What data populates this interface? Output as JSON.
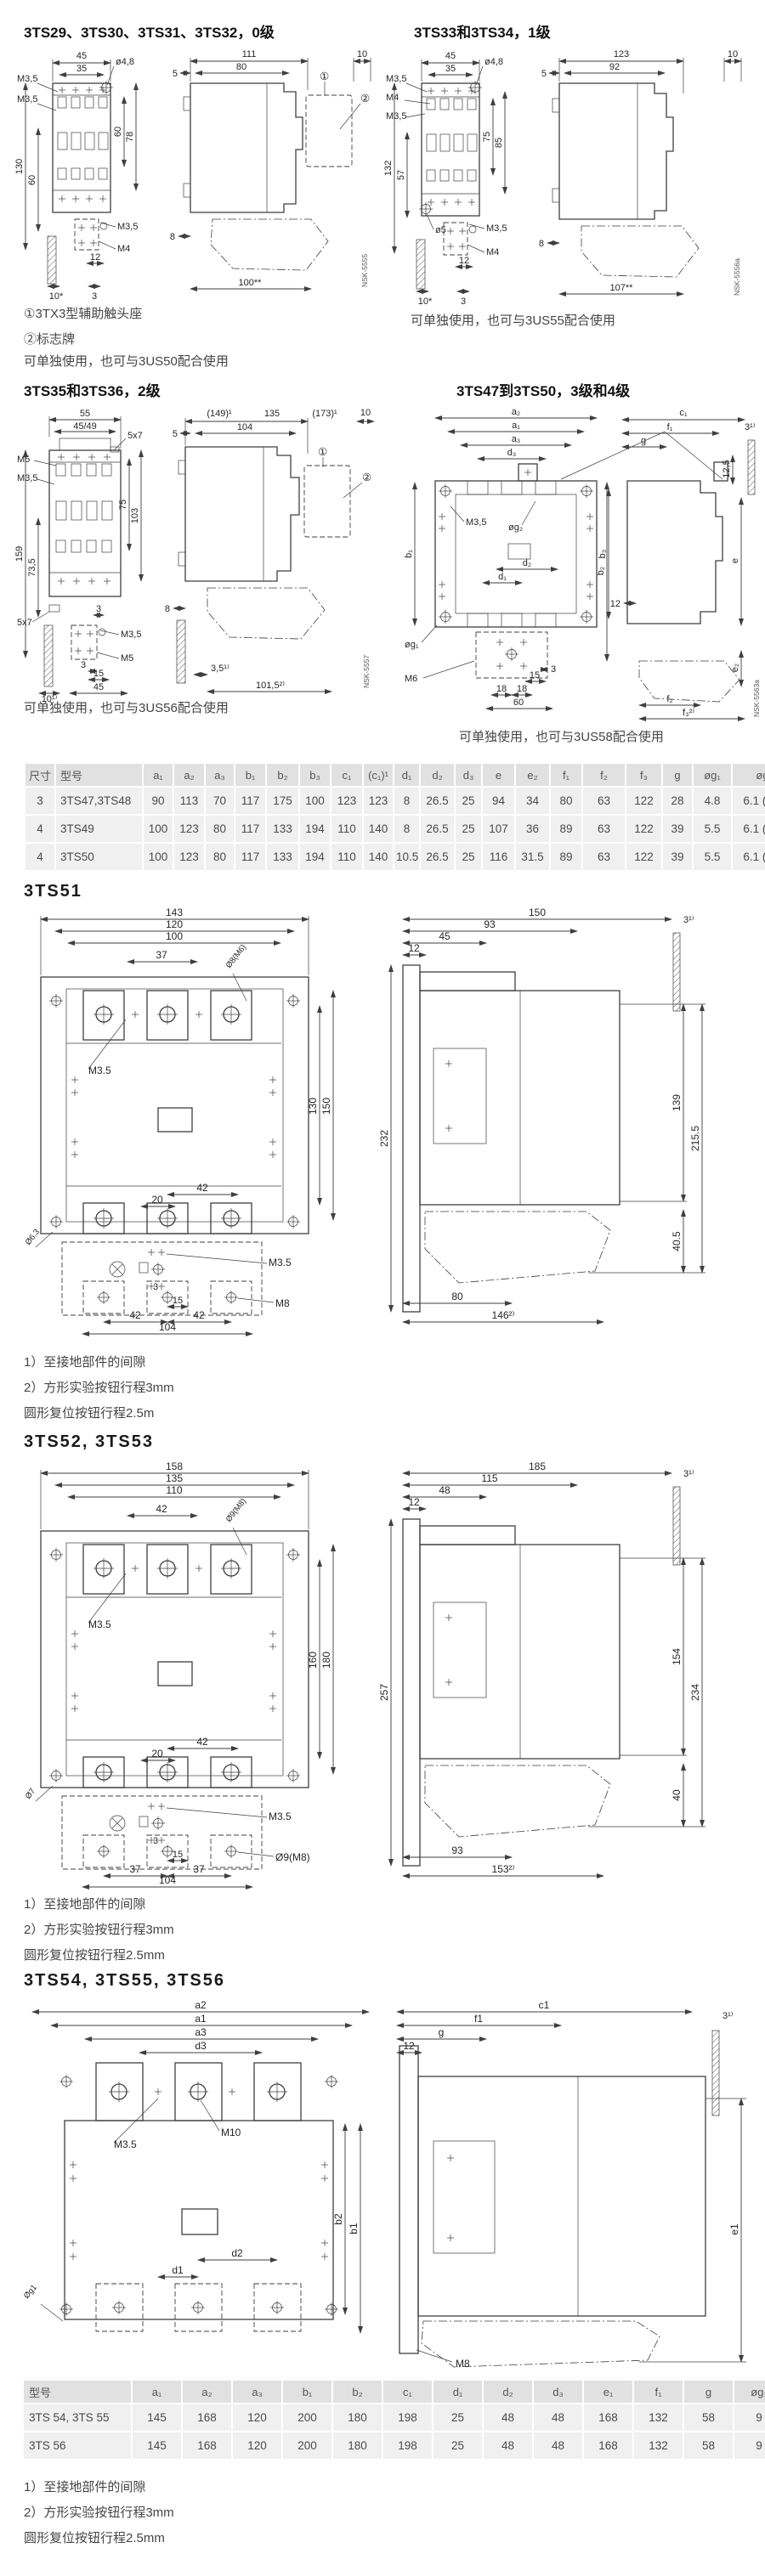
{
  "colors": {
    "line": "#3f3f3f",
    "table_header_bg": "#e1e1e1",
    "table_row_bg": "#f0f0f0",
    "title_text": "#111111",
    "note_text": "#454545"
  },
  "sections": {
    "s29": {
      "title": "3TS29、3TS30、3TS31、3TS32，0级",
      "notes": [
        "①3TX3型辅助触头座",
        "②标志牌",
        "可单独使用，也可与3US50配合使用"
      ]
    },
    "s33": {
      "title": "3TS33和3TS34，1级",
      "notes": [
        "可单独使用，也可与3US55配合使用"
      ]
    },
    "s35": {
      "title": "3TS35和3TS36，2级",
      "notes": [
        "可单独使用，也可与3US56配合使用"
      ]
    },
    "s47": {
      "title": "3TS47到3TS50，3级和4级",
      "notes": [
        "可单独使用，也可与3US58配合使用"
      ]
    },
    "s51": {
      "title": "3TS51",
      "notes": [
        "1）至接地部件的间隙",
        "2）方形实验按钮行程3mm",
        "圆形复位按钮行程2.5m"
      ]
    },
    "s52": {
      "title": "3TS52, 3TS53",
      "notes": [
        "1）至接地部件的间隙",
        "2）方形实验按钮行程3mm",
        "圆形复位按钮行程2.5mm"
      ]
    },
    "s54": {
      "title": "3TS54, 3TS55, 3TS56",
      "notes": [
        "1）至接地部件的间隙",
        "2）方形实验按钮行程3mm",
        "圆形复位按钮行程2.5mm"
      ]
    }
  },
  "drawings": {
    "p29f": {
      "w45": "45",
      "hole": "ø4,8",
      "m35a": "M3,5",
      "w35": "35",
      "m35b": "M3,5",
      "h60r": "60",
      "h78": "78",
      "h130": "130",
      "h60l": "60",
      "m35c": "M3,5",
      "m4": "M4",
      "w12": "12",
      "w10": "10*",
      "w3": "3"
    },
    "p29s": {
      "d111": "111",
      "d10": "10",
      "d5": "5",
      "d80": "80",
      "c1": "①",
      "c2": "②",
      "d8": "8",
      "d100": "100**",
      "nsk": "NSK-5555"
    },
    "p33f": {
      "w45": "45",
      "hole": "ø4,8",
      "m35a": "M3,5",
      "w35": "35",
      "m4a": "M4",
      "m35b": "M3,5",
      "h75": "75",
      "h85": "85",
      "h132": "132",
      "h57": "57",
      "hole5": "ø5",
      "m35c": "M3,5",
      "m4b": "M4",
      "w12": "12",
      "w10": "10*",
      "w3": "3"
    },
    "p33s": {
      "d123": "123",
      "d10": "10",
      "d5": "5",
      "d92": "92",
      "d8": "8",
      "d107": "107**",
      "nsk": "NSK-5556a"
    },
    "p35f": {
      "w55": "55",
      "w4549": "45/49",
      "slota": "5x7",
      "m5a": "M5",
      "m35a": "M3,5",
      "h75": "75",
      "h103": "103",
      "h159": "159",
      "h735": "73,5",
      "slotb": "5x7",
      "d3a": "3",
      "m35b": "M3,5",
      "m5b": "M5",
      "d3b": "3",
      "d15": "15",
      "w10": "10¹⁾",
      "w45": "45"
    },
    "p35s": {
      "d149": "(149)¹",
      "d135": "135",
      "d173": "(173)¹",
      "d10": "10",
      "d5": "5",
      "d104": "104",
      "c1": "①",
      "c2": "②",
      "d8": "8",
      "d35": "3,5¹⁾",
      "d1015": "101,5²⁾",
      "nsk": "NSK-5557"
    },
    "p47f": {
      "a2": "a₂",
      "a1": "a₁",
      "a3": "a₃",
      "d3": "d₃",
      "m35": "M3,5",
      "g2": "øg₂",
      "b1": "b₁",
      "b3": "b₃",
      "d2": "d₂",
      "d1": "d₁",
      "g1": "øg₁",
      "m6": "M6",
      "n3": "3",
      "n15": "15",
      "n18a": "18",
      "n18b": "18",
      "n60": "60"
    },
    "p47s": {
      "c1": "c₁",
      "f1": "f₁",
      "g": "g",
      "d125": "12,5",
      "n3": "3¹⁾",
      "b2": "b₂",
      "e": "e",
      "n12": "12",
      "e2": "e₂",
      "f2": "f₂",
      "f3": "f₃²⁾",
      "nsk": "NSK-5563a"
    },
    "p51f": {
      "w143": "143",
      "w120": "120",
      "w100": "100",
      "w37": "37",
      "holet": "Ø8(M6)",
      "m35a": "M3.5",
      "h130": "130",
      "h150": "150",
      "w42a": "42",
      "w20": "20",
      "holeb": "Ø6.3",
      "m35b": "M3.5",
      "m8": "M8",
      "n3": "3",
      "n15": "15",
      "w42b": "42",
      "w42c": "42",
      "w104": "104"
    },
    "p51s": {
      "d150": "150",
      "d93": "93",
      "d45": "45",
      "d12": "12",
      "n3": "3¹⁾",
      "h232": "232",
      "h139": "139",
      "h2155": "215.5",
      "h405": "40.5",
      "d80": "80",
      "d146": "146²⁾"
    },
    "p52f": {
      "w158": "158",
      "w135": "135",
      "w110": "110",
      "w42a": "42",
      "holet": "Ø9(M8)",
      "m35a": "M3.5",
      "h160": "160",
      "h180": "180",
      "w42b": "42",
      "w20": "20",
      "holel": "Ø7",
      "m35b": "M3.5",
      "holeb": "Ø9(M8)",
      "n3": "3",
      "n15": "15",
      "w37a": "37",
      "w37b": "37",
      "w104": "104"
    },
    "p52s": {
      "d185": "185",
      "d115": "115",
      "d48": "48",
      "d12": "12",
      "n3": "3¹⁾",
      "h257": "257",
      "h154": "154",
      "h234": "234",
      "h40": "40",
      "d93": "93",
      "d153": "153²⁾"
    },
    "p54f": {
      "a2": "a2",
      "a1": "a1",
      "a3": "a3",
      "d3": "d3",
      "m35": "M3.5",
      "m10": "M10",
      "b2": "b2",
      "b1": "b1",
      "d2": "d2",
      "d1": "d1",
      "g1": "Øg1"
    },
    "p54s": {
      "c1": "c1",
      "f1": "f1",
      "g": "g",
      "d12": "12",
      "n3": "3¹⁾",
      "e1": "e1",
      "m8": "M8"
    }
  },
  "table1": {
    "headers": [
      "尺寸",
      "型号",
      "a₁",
      "a₂",
      "a₃",
      "b₁",
      "b₂",
      "b₃",
      "c₁",
      "(c₁)¹",
      "d₁",
      "d₂",
      "d₃",
      "e",
      "e₂",
      "f₁",
      "f₂",
      "f₃",
      "g",
      "øg₁",
      "øg₂"
    ],
    "rows": [
      [
        "3",
        "3TS47,3TS48",
        "90",
        "113",
        "70",
        "117",
        "175",
        "100",
        "123",
        "123",
        "8",
        "26.5",
        "25",
        "94",
        "34",
        "80",
        "63",
        "122",
        "28",
        "4.8",
        "6.1 (M6)"
      ],
      [
        "4",
        "3TS49",
        "100",
        "123",
        "80",
        "117",
        "133",
        "194",
        "110",
        "140",
        "8",
        "26.5",
        "25",
        "107",
        "36",
        "89",
        "63",
        "122",
        "39",
        "5.5",
        "6.1 (M6)"
      ],
      [
        "4",
        "3TS50",
        "100",
        "123",
        "80",
        "117",
        "133",
        "194",
        "110",
        "140",
        "10.5",
        "26.5",
        "25",
        "116",
        "31.5",
        "89",
        "63",
        "122",
        "39",
        "5.5",
        "6.1 (M6)"
      ]
    ]
  },
  "table2": {
    "headers": [
      "型号",
      "a₁",
      "a₂",
      "a₃",
      "b₁",
      "b₂",
      "c₁",
      "d₁",
      "d₂",
      "d₃",
      "e₁",
      "f₁",
      "g",
      "øg₁"
    ],
    "rows": [
      [
        "3TS 54, 3TS 55",
        "145",
        "168",
        "120",
        "200",
        "180",
        "198",
        "25",
        "48",
        "48",
        "168",
        "132",
        "58",
        "9"
      ],
      [
        "3TS 56",
        "145",
        "168",
        "120",
        "200",
        "180",
        "198",
        "25",
        "48",
        "48",
        "168",
        "132",
        "58",
        "9"
      ]
    ]
  }
}
